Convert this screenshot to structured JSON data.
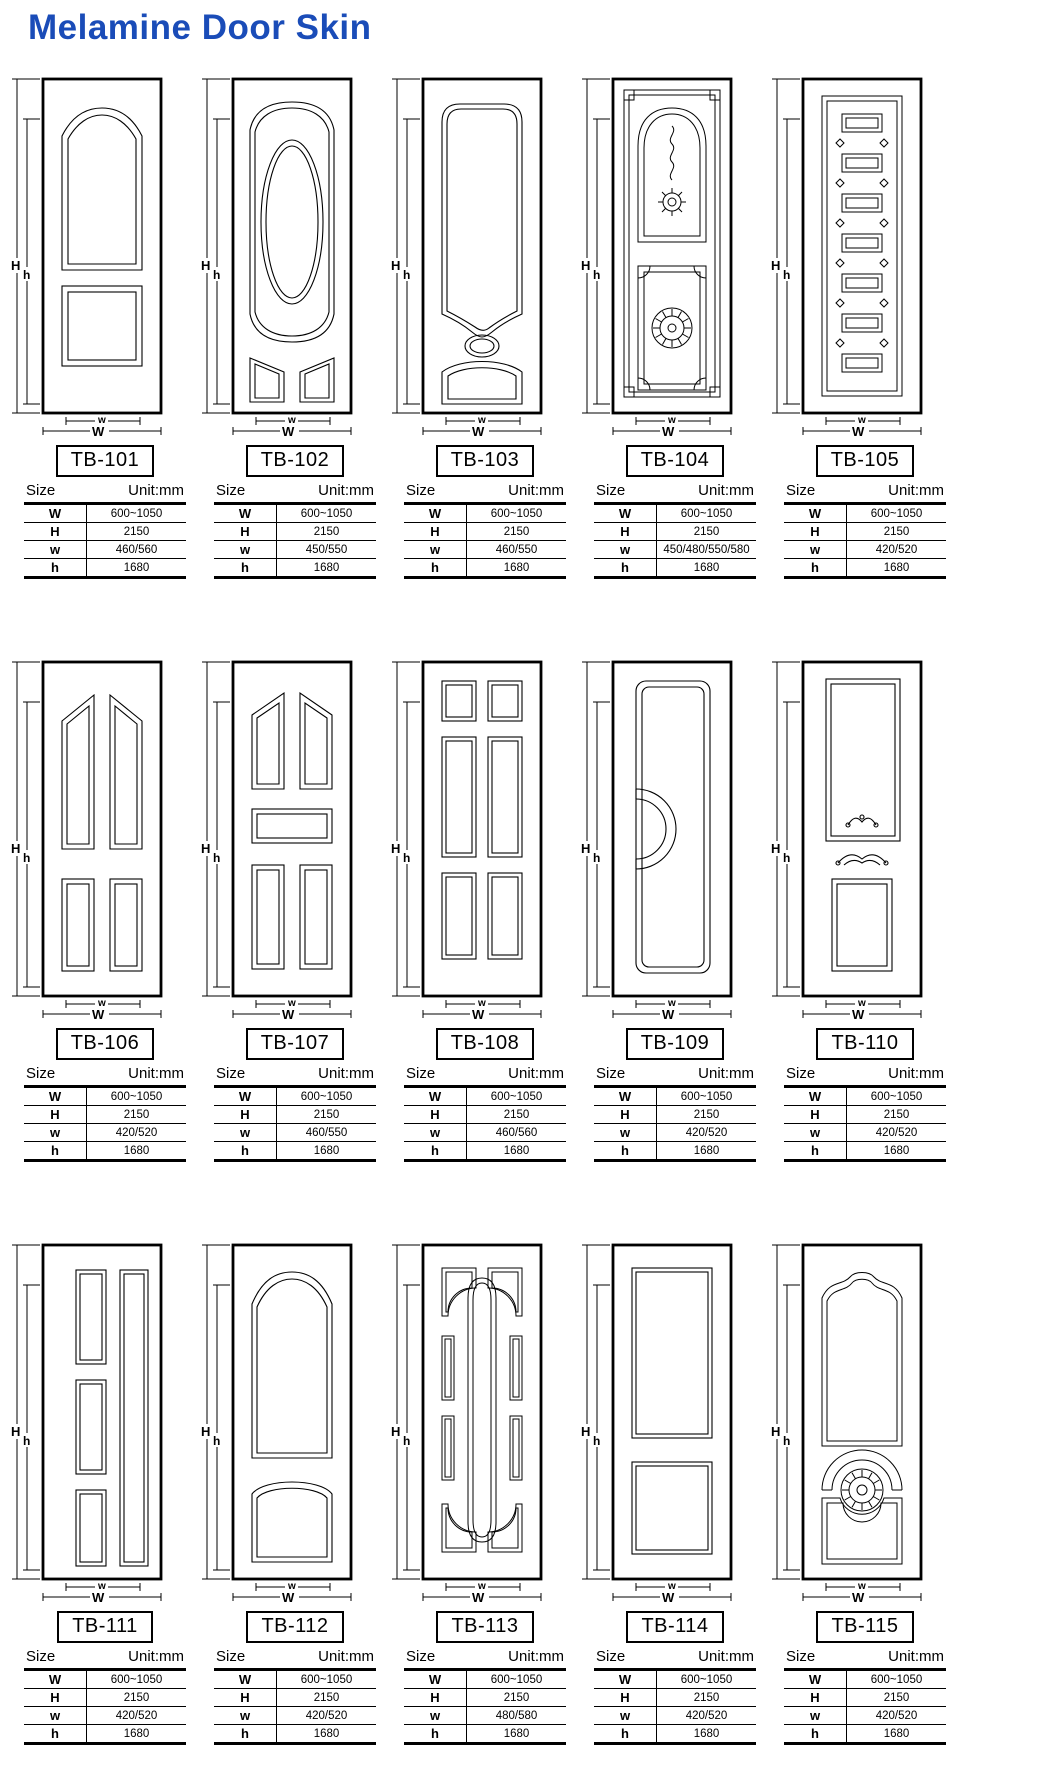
{
  "title": "Melamine Door Skin",
  "colors": {
    "title_blue": "#1a4cb8",
    "line_black": "#000000"
  },
  "labels": {
    "size": "Size",
    "unit": "Unit:mm"
  },
  "dim_labels": {
    "outer_height": "H",
    "inner_height": "h",
    "inner_width": "w",
    "outer_width": "W"
  },
  "spec_keys": [
    "W",
    "H",
    "w",
    "h"
  ],
  "products": [
    {
      "model": "TB-101",
      "specs": {
        "W": "600~1050",
        "H": "2150",
        "w": "460/560",
        "h": "1680"
      }
    },
    {
      "model": "TB-102",
      "specs": {
        "W": "600~1050",
        "H": "2150",
        "w": "450/550",
        "h": "1680"
      }
    },
    {
      "model": "TB-103",
      "specs": {
        "W": "600~1050",
        "H": "2150",
        "w": "460/550",
        "h": "1680"
      }
    },
    {
      "model": "TB-104",
      "specs": {
        "W": "600~1050",
        "H": "2150",
        "w": "450/480/550/580",
        "h": "1680"
      }
    },
    {
      "model": "TB-105",
      "specs": {
        "W": "600~1050",
        "H": "2150",
        "w": "420/520",
        "h": "1680"
      }
    },
    {
      "model": "TB-106",
      "specs": {
        "W": "600~1050",
        "H": "2150",
        "w": "420/520",
        "h": "1680"
      }
    },
    {
      "model": "TB-107",
      "specs": {
        "W": "600~1050",
        "H": "2150",
        "w": "460/550",
        "h": "1680"
      }
    },
    {
      "model": "TB-108",
      "specs": {
        "W": "600~1050",
        "H": "2150",
        "w": "460/560",
        "h": "1680"
      }
    },
    {
      "model": "TB-109",
      "specs": {
        "W": "600~1050",
        "H": "2150",
        "w": "420/520",
        "h": "1680"
      }
    },
    {
      "model": "TB-110",
      "specs": {
        "W": "600~1050",
        "H": "2150",
        "w": "420/520",
        "h": "1680"
      }
    },
    {
      "model": "TB-111",
      "specs": {
        "W": "600~1050",
        "H": "2150",
        "w": "420/520",
        "h": "1680"
      }
    },
    {
      "model": "TB-112",
      "specs": {
        "W": "600~1050",
        "H": "2150",
        "w": "420/520",
        "h": "1680"
      }
    },
    {
      "model": "TB-113",
      "specs": {
        "W": "600~1050",
        "H": "2150",
        "w": "480/580",
        "h": "1680"
      }
    },
    {
      "model": "TB-114",
      "specs": {
        "W": "600~1050",
        "H": "2150",
        "w": "420/520",
        "h": "1680"
      }
    },
    {
      "model": "TB-115",
      "specs": {
        "W": "600~1050",
        "H": "2150",
        "w": "420/520",
        "h": "1680"
      }
    }
  ]
}
